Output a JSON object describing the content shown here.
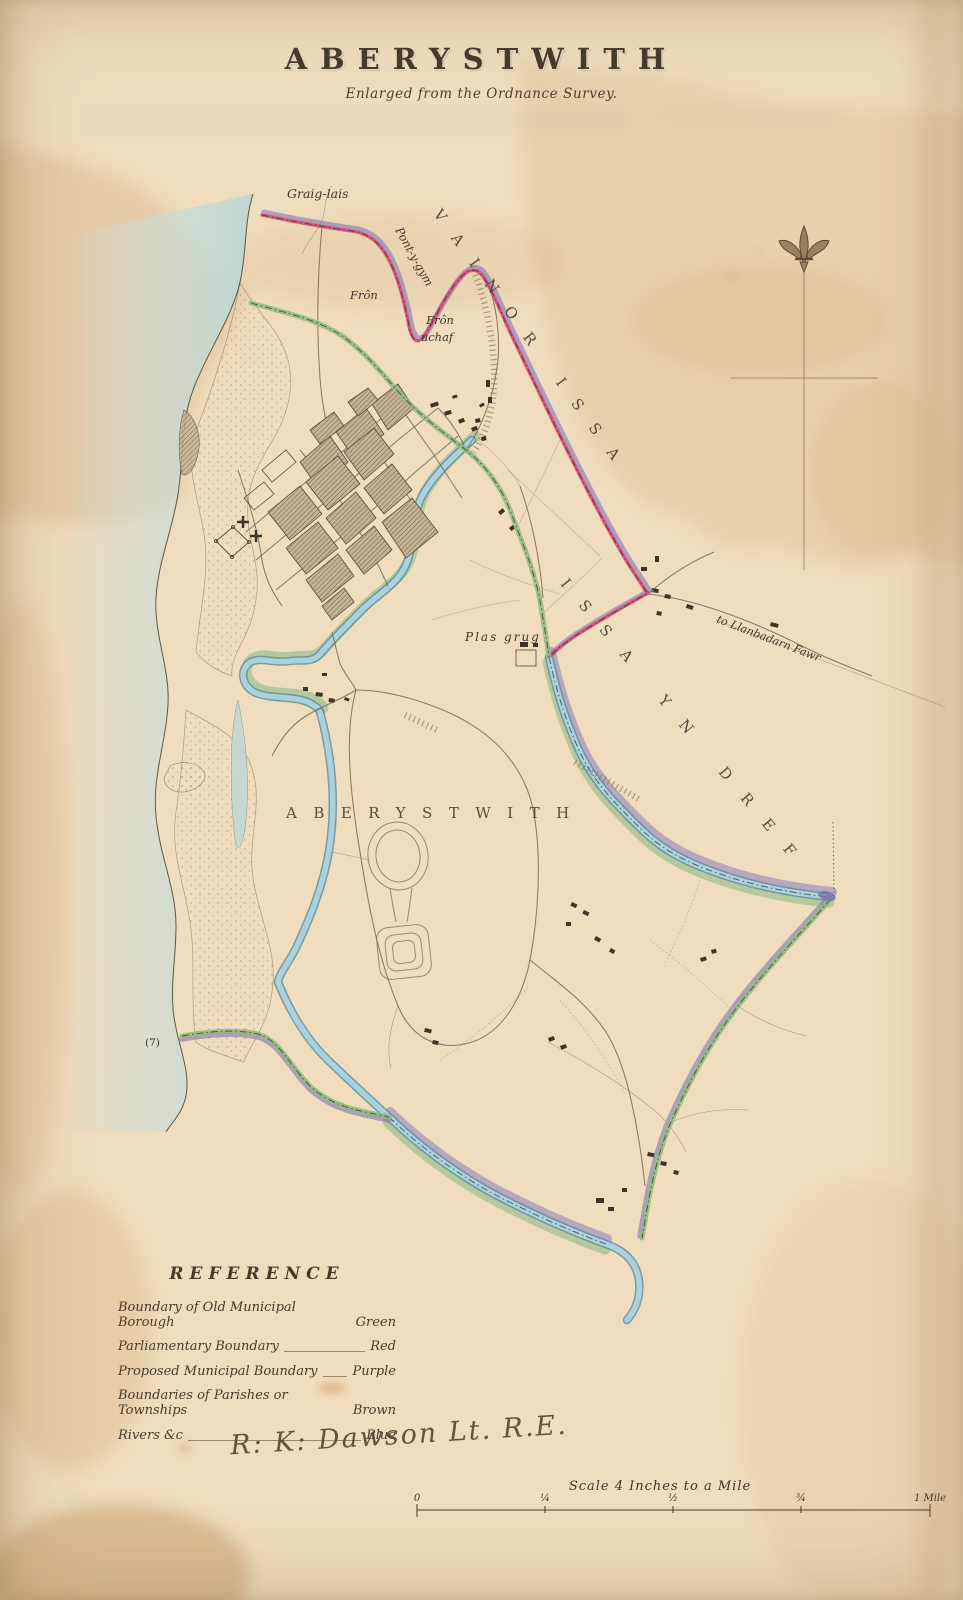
{
  "title": {
    "main": "ABERYSTWITH",
    "subtitle": "Enlarged from the Ordnance Survey."
  },
  "map_labels": {
    "graig_lais": "Graig-lais",
    "pont_y_gym": "Pont-y-gym",
    "fron": "Frôn",
    "fron_uchaf_line1": "Frôn",
    "fron_uchaf_line2": "uchaf",
    "township_vainor_issa": "VAINOR ISSA",
    "township_issa_yn_dref": "ISSA YN DREF",
    "parish_aberystwith": "ABERYSTWITH",
    "plas_grug": "Plas grug",
    "to_llanbadarn_fawr": "to Llanbadarn Fawr",
    "plot_number": "(7)"
  },
  "reference": {
    "heading": "REFERENCE",
    "entries": [
      {
        "label": "Boundary of Old Municipal Borough",
        "value": "Green"
      },
      {
        "label": "Parliamentary Boundary",
        "value": "Red"
      },
      {
        "label": "Proposed Municipal Boundary",
        "value": "Purple"
      },
      {
        "label": "Boundaries of Parishes or Townships",
        "value": "Brown"
      },
      {
        "label": "Rivers &c",
        "value": "Blue"
      }
    ]
  },
  "signature": "R: K: Dawson Lt. R.E.",
  "scale_bar": {
    "caption": "Scale 4 Inches to a Mile",
    "ticks": [
      "0",
      "¼",
      "½",
      "¾",
      "1 Mile"
    ]
  },
  "compass": {
    "icon": "fleur-de-lis"
  },
  "colors": {
    "paper": "#efddbd",
    "stain": "#d7b68a",
    "sea": "#c7dedb",
    "river": "#a9d2dc",
    "boundary_green": "#8fba7e",
    "boundary_red": "#d64d72",
    "boundary_purple": "#8b7cba",
    "boundary_brown": "#a98a62",
    "ink": "#3e352a"
  }
}
